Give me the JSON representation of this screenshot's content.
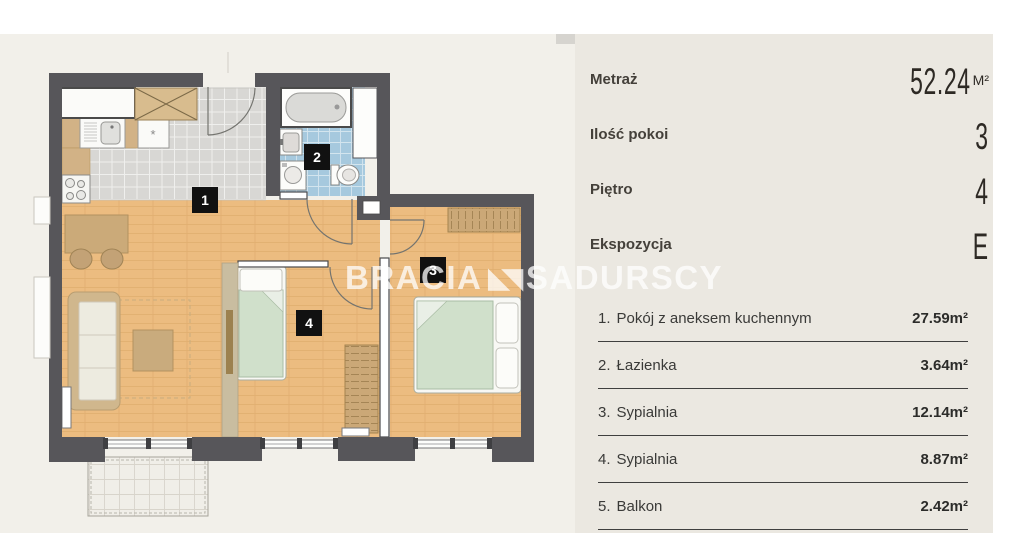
{
  "panel": {
    "info": [
      {
        "label": "Metraż",
        "value": "52.24",
        "unit": "M²"
      },
      {
        "label": "Ilość pokoi",
        "value": "3"
      },
      {
        "label": "Piętro",
        "value": "4"
      },
      {
        "label": "Ekspozycja",
        "value": "E"
      }
    ],
    "rooms": [
      {
        "num": "1.",
        "name": "Pokój z aneksem kuchennym",
        "area": "27.59m²"
      },
      {
        "num": "2.",
        "name": "Łazienka",
        "area": "3.64m²"
      },
      {
        "num": "3.",
        "name": "Sypialnia",
        "area": "12.14m²"
      },
      {
        "num": "4.",
        "name": "Sypialnia",
        "area": "8.87m²"
      },
      {
        "num": "5.",
        "name": "Balkon",
        "area": "2.42m²"
      }
    ]
  },
  "logo": {
    "part1": "BRACIA",
    "mark": "◣◥",
    "part2": "SADURSCY"
  },
  "plan": {
    "labels": [
      "1",
      "2",
      "3",
      "4"
    ],
    "colors": {
      "plan_bg": "#f2f0ea",
      "panel_bg": "#ebe8e1",
      "wall": "#57565a",
      "wood": "#ecbc80",
      "tile": "#d8d7d4",
      "bath": "#a6c9de",
      "furniture_tan": "#cbaa79",
      "bed_green": "#d0e0cb",
      "label_bg": "#111111",
      "watermark": "#ffffff"
    }
  }
}
